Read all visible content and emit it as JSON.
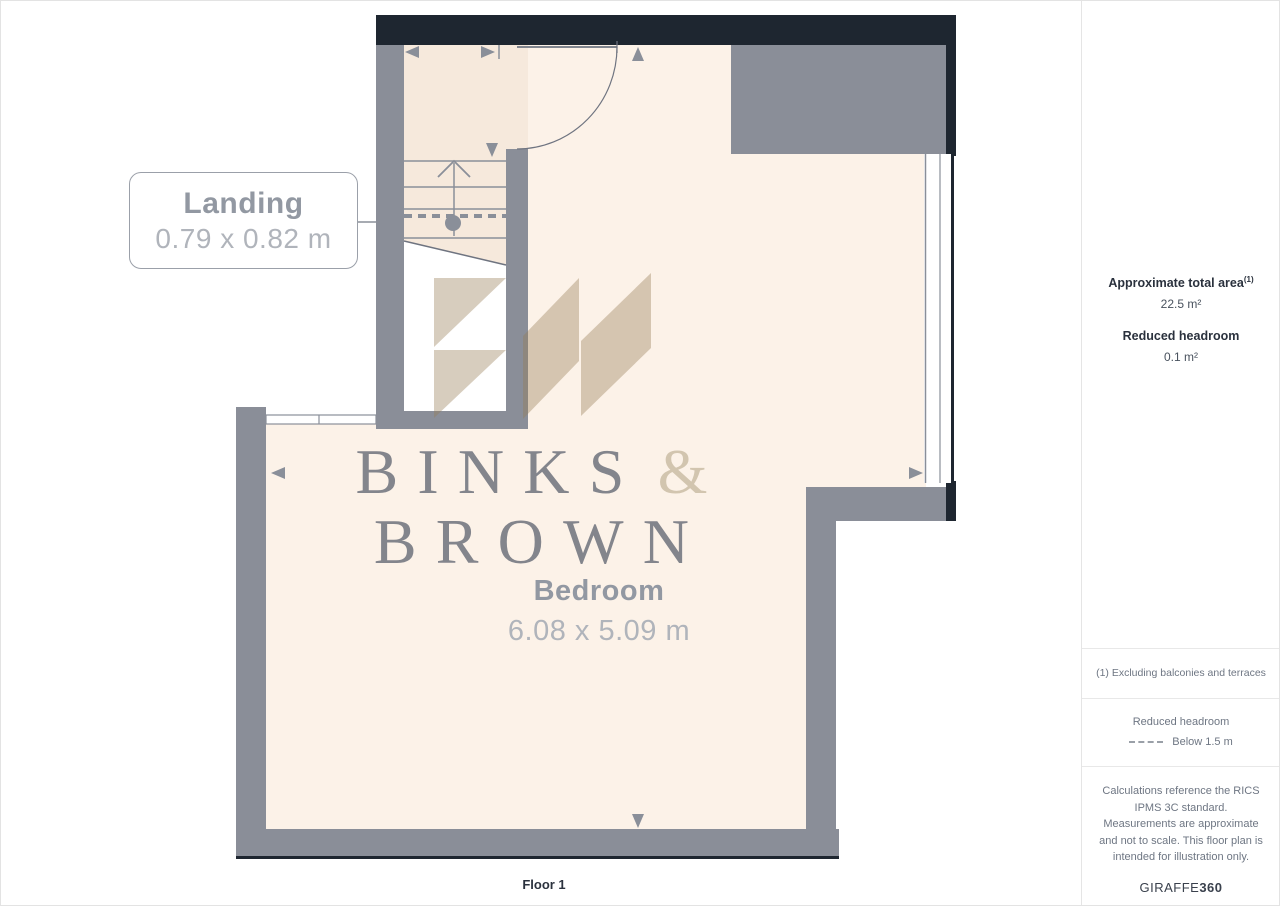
{
  "plan": {
    "floor_label": "Floor 1",
    "rooms": [
      {
        "name": "Landing",
        "dims": "0.79 x 0.82 m"
      },
      {
        "name": "Bedroom",
        "dims": "6.08 x 5.09 m"
      }
    ],
    "watermark": {
      "word1": "BINKS",
      "ampersand": "&",
      "word2": "BROWN"
    }
  },
  "sidebar": {
    "total_area": {
      "label": "Approximate total area",
      "footnote_marker": "(1)",
      "value": "22.5 m²"
    },
    "reduced_headroom": {
      "label": "Reduced headroom",
      "value": "0.1 m²"
    },
    "footnote": "(1) Excluding balconies and terraces",
    "legend": {
      "title": "Reduced headroom",
      "item": "Below 1.5 m"
    },
    "disclaimer": "Calculations reference the RICS IPMS 3C standard. Measurements are approximate and not to scale. This floor plan is intended for illustration only.",
    "brand": {
      "name": "GIRAFFE",
      "suffix": "360"
    }
  },
  "colors": {
    "wall_gray": "#8a8e98",
    "wall_dark": "#1e2630",
    "floor_bedroom": "#fcf2e8",
    "floor_landing": "#f6e9dc",
    "plan_line_gray": "#8a8f99",
    "watermark_text": "#686c78",
    "watermark_ampersand": "#d0c2ac",
    "sidebar_text": "#6e7683",
    "sidebar_heading": "#2a313d"
  }
}
